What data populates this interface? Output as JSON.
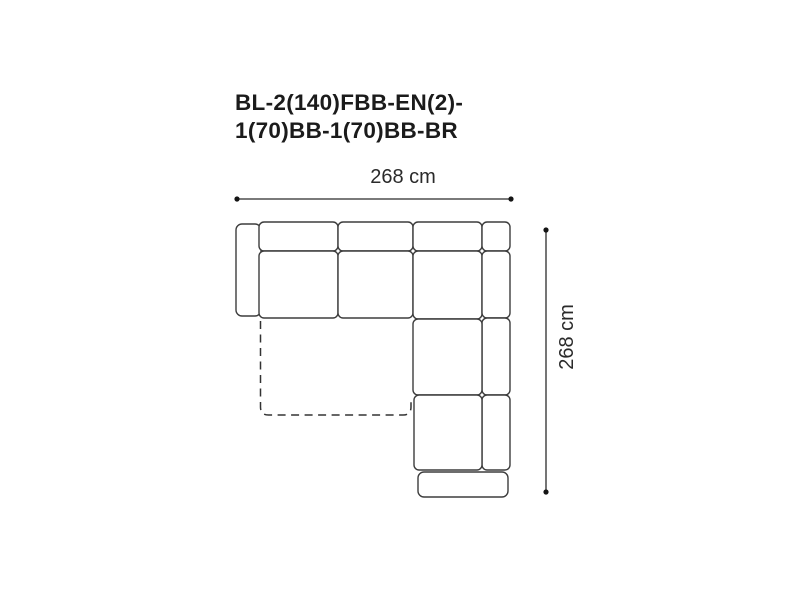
{
  "product": {
    "code": "BL-2(140)FBB-EN(2)-1(70)BB-1(70)BB-BR",
    "code_lines": [
      "BL-2(140)FBB-EN(2)-",
      "1(70)BB-1(70)BB-BR"
    ]
  },
  "dimensions": {
    "width_label": "268 cm",
    "depth_label": "268 cm"
  },
  "colors": {
    "background": "#ffffff",
    "outline": "#3d3d3d",
    "dimension_line": "#2b2b2b",
    "title_text": "#1b1b1b"
  }
}
